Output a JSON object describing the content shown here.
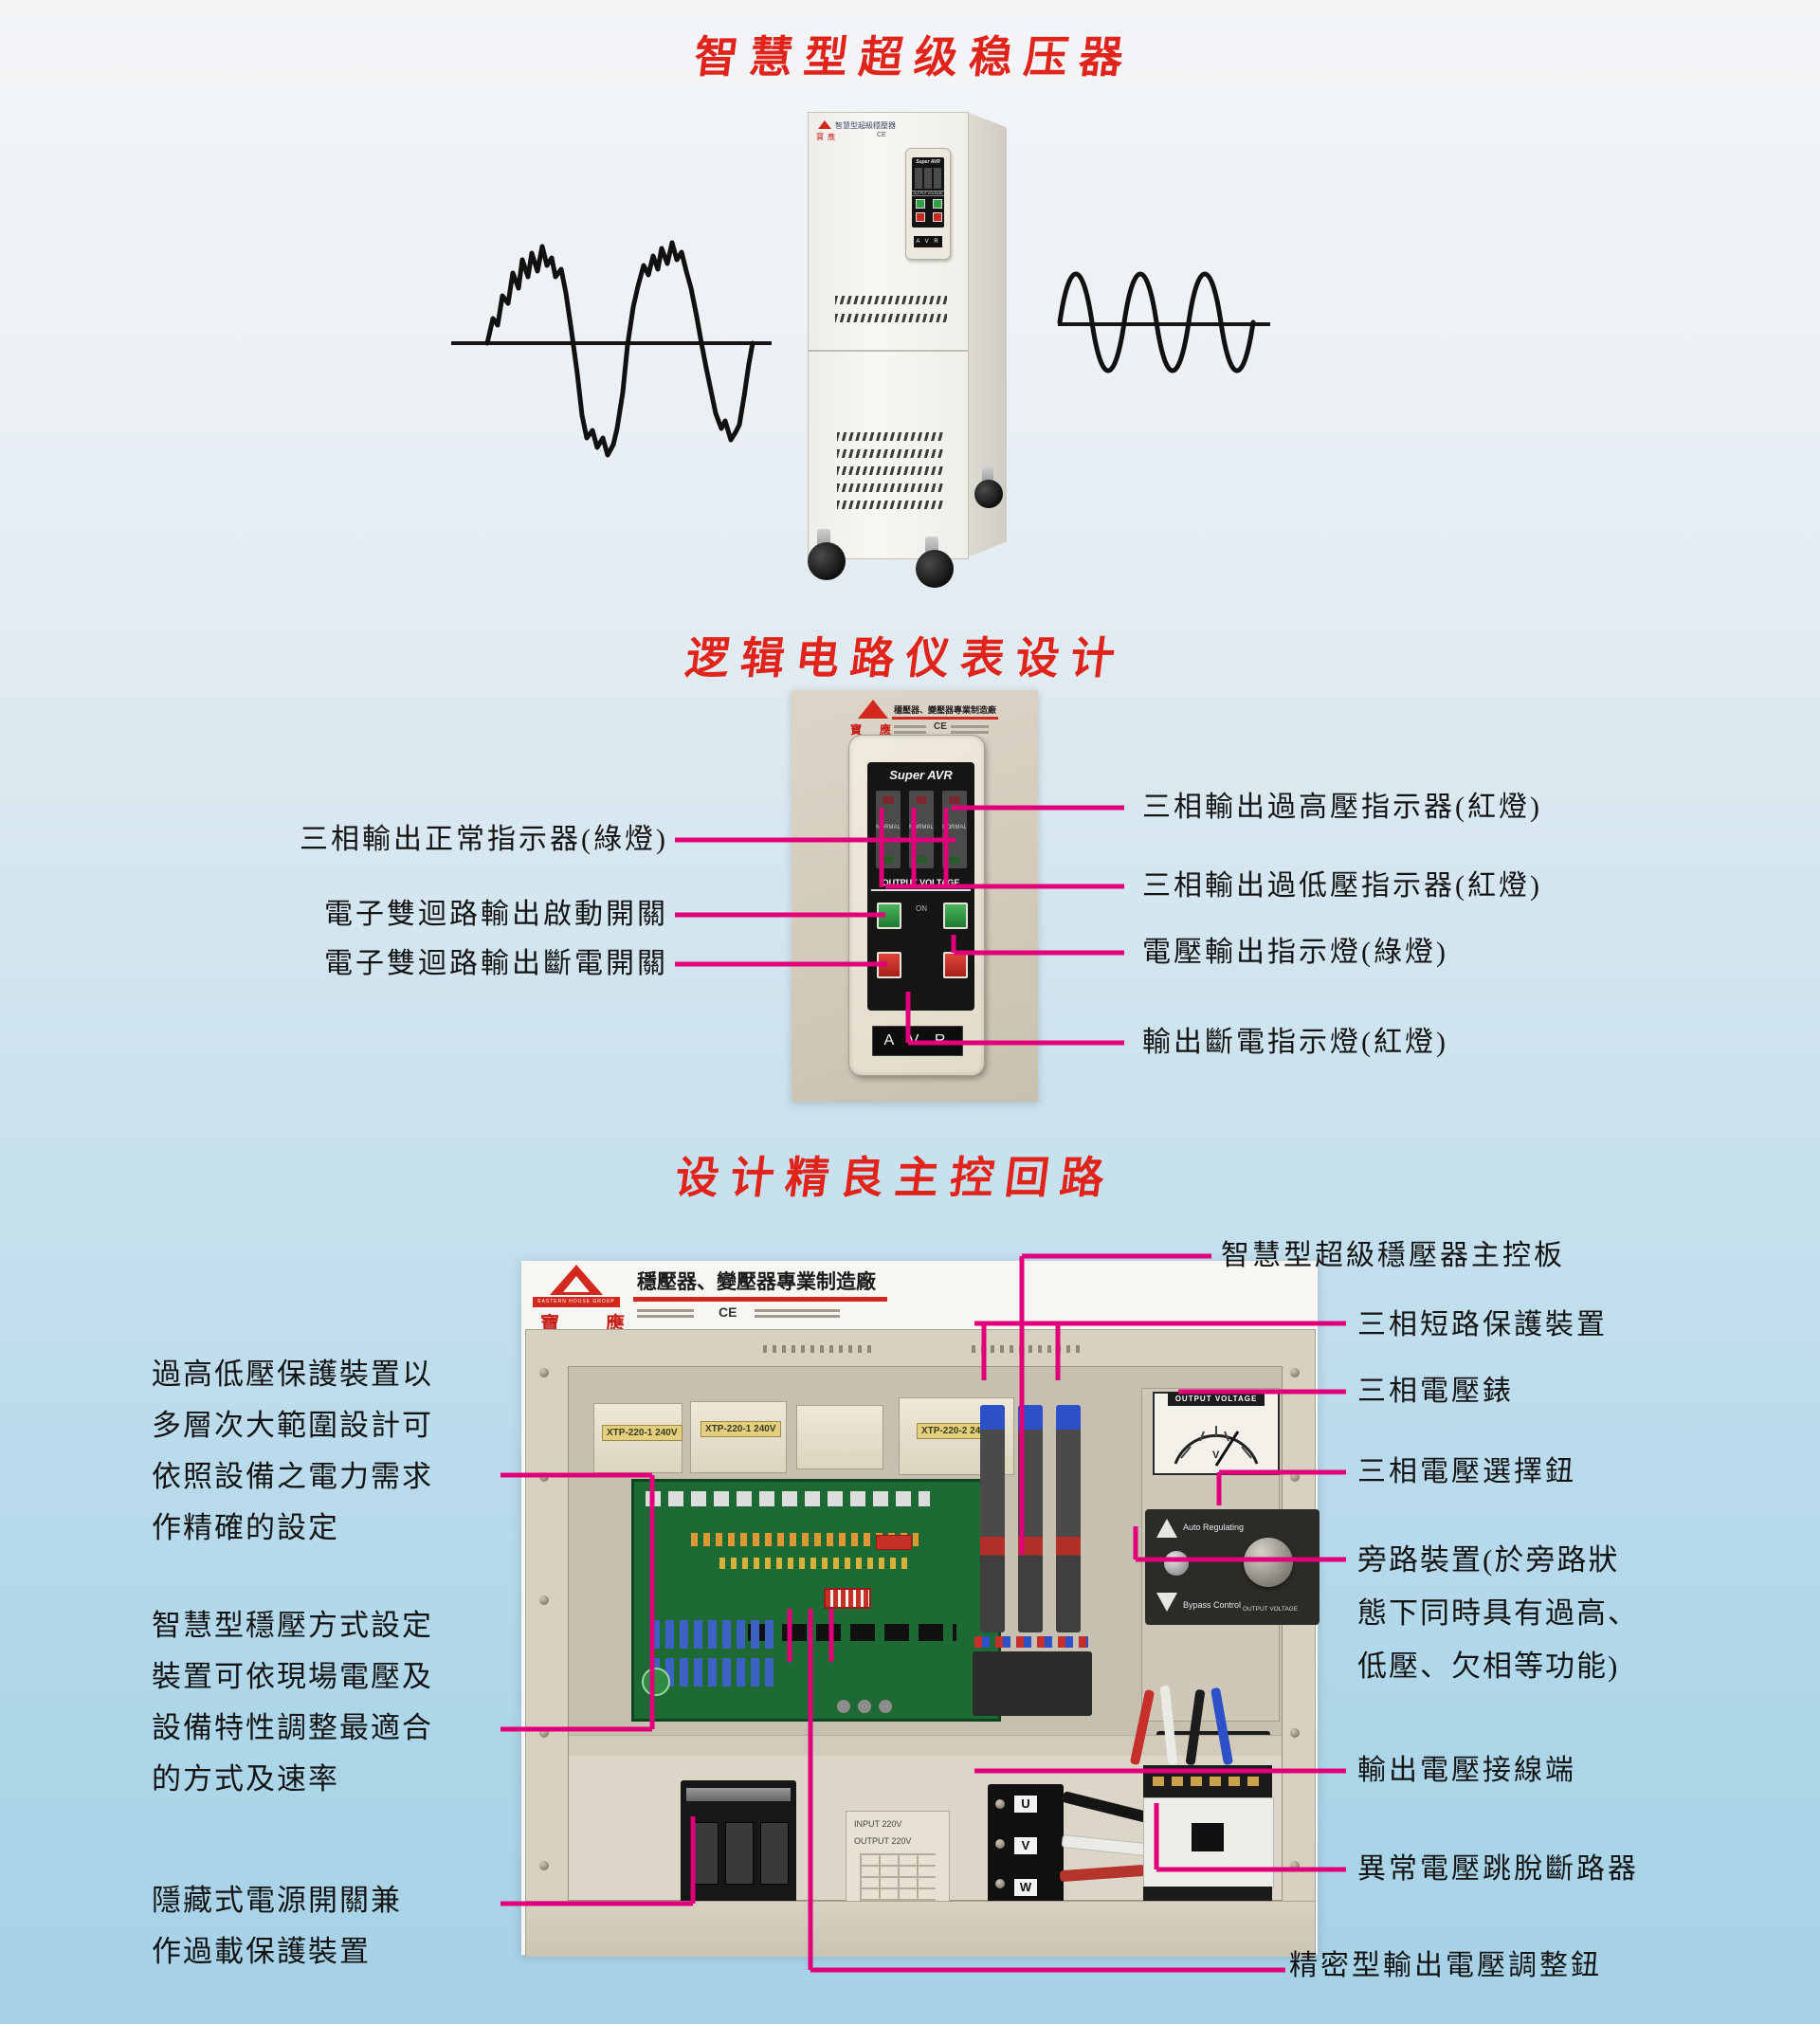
{
  "page": {
    "accent_red": "#e0231b",
    "callout_pink": "#e2007a"
  },
  "section1": {
    "title": "智慧型超级稳压器",
    "device": {
      "top_label": "智慧型超級穩壓器",
      "logo_cn": "寶應",
      "ce": "CE",
      "panel_brand": "Super AVR",
      "panel_output": "OUTPUT VOLTAGE",
      "panel_on": "ON",
      "panel_avr": "A V R"
    }
  },
  "section2": {
    "title": "逻辑电路仪表设计",
    "photo": {
      "logo_cn": "寶 應",
      "tagline": "穩壓器、變壓器專業制造廠",
      "ce": "CE",
      "brand": "Super AVR",
      "normal": "NORMAL",
      "output_voltage": "OUTPUT VOLTAGE",
      "on": "ON",
      "avr": "A V R"
    },
    "labels_left": [
      "三相輸出正常指示器(綠燈)",
      "電子雙迴路輸出啟動開關",
      "電子雙迴路輸出斷電開關"
    ],
    "labels_right": [
      "三相輸出過高壓指示器(紅燈)",
      "三相輸出過低壓指示器(紅燈)",
      "電壓輸出指示燈(綠燈)",
      "輸出斷電指示燈(紅燈)"
    ]
  },
  "section3": {
    "title": "设计精良主控回路",
    "photo": {
      "logo_en": "EASTERN HOUSE GROUP",
      "logo_cn": "寶 應",
      "tagline": "穩壓器、變壓器專業制造廠",
      "ce": "CE",
      "transformer_labels": [
        "XTP-220-1 240V",
        "XTP-220-1 240V",
        "XTP-220-2 240V"
      ],
      "meter_title": "OUTPUT VOLTAGE",
      "meter_unit": "V",
      "auto_regulating": "Auto Regulating",
      "bypass_control": "Bypass Control",
      "knob_label": "OUTPUT VOLTAGE",
      "input_label": "INPUT 220V",
      "output_label": "OUTPUT 220V",
      "cable_holder": "CABLE HOLDER",
      "terminals": [
        "U",
        "V",
        "W"
      ]
    },
    "labels_left": [
      {
        "lines": [
          "過高低壓保護裝置以",
          "多層次大範圍設計可",
          "依照設備之電力需求",
          "作精確的設定"
        ]
      },
      {
        "lines": [
          "智慧型穩壓方式設定",
          "裝置可依現場電壓及",
          "設備特性調整最適合",
          "的方式及速率"
        ]
      },
      {
        "lines": [
          "隱藏式電源開關兼",
          "作過載保護裝置"
        ]
      }
    ],
    "labels_right": [
      {
        "lines": [
          "智慧型超級穩壓器主控板"
        ]
      },
      {
        "lines": [
          "三相短路保護裝置"
        ]
      },
      {
        "lines": [
          "三相電壓錶"
        ]
      },
      {
        "lines": [
          "三相電壓選擇鈕"
        ]
      },
      {
        "lines": [
          "旁路裝置(於旁路狀",
          "態下同時具有過高、",
          "低壓、欠相等功能)"
        ]
      },
      {
        "lines": [
          "輸出電壓接線端"
        ]
      },
      {
        "lines": [
          "異常電壓跳脫斷路器"
        ]
      },
      {
        "lines": [
          "精密型輸出電壓調整鈕"
        ]
      }
    ]
  }
}
